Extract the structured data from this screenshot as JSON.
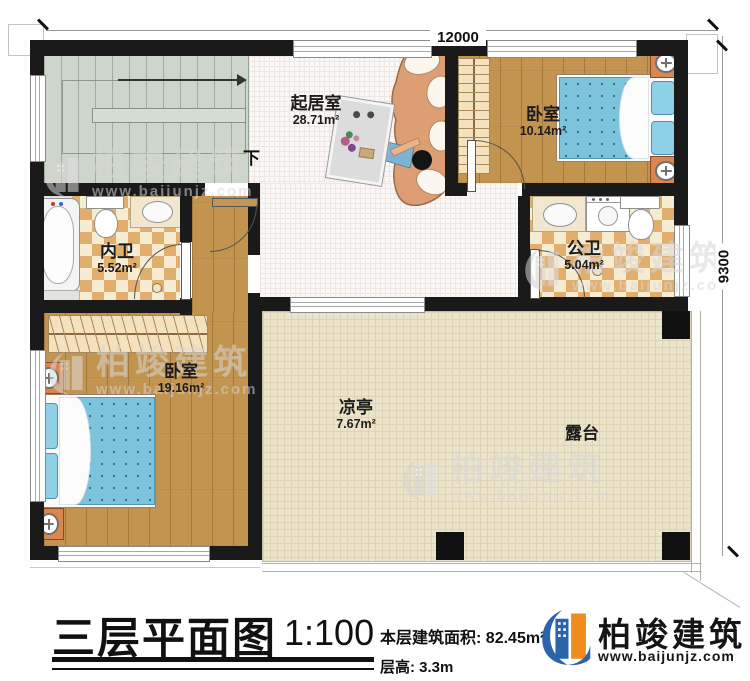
{
  "dimensions": {
    "top_width": "12000",
    "right_height": "9300"
  },
  "stairs": {
    "direction_label": "下"
  },
  "rooms": {
    "living": {
      "name": "起居室",
      "area": "28.71m²"
    },
    "bedroom_top": {
      "name": "卧室",
      "area": "10.14m²"
    },
    "bath_inner": {
      "name": "内卫",
      "area": "5.52m²"
    },
    "bath_public": {
      "name": "公卫",
      "area": "5.04m²"
    },
    "bedroom_left": {
      "name": "卧室",
      "area": "19.16m²"
    },
    "pavilion": {
      "name": "凉亭",
      "area": "7.67m²"
    },
    "terrace": {
      "name": "露台"
    }
  },
  "title_block": {
    "plan_title": "三层平面图",
    "scale": "1:100",
    "area_label": "本层建筑面积:",
    "area_value": "82.45m²",
    "floor_height_label": "层高:",
    "floor_height_value": "3.3m"
  },
  "brand": {
    "name": "柏竣建筑",
    "website": "www.baijunjz.com"
  },
  "watermark": {
    "name": "柏竣建筑",
    "website": "www.baijunjz.com"
  },
  "colors": {
    "wall": "#1a1a1a",
    "wood_floor": "#c2944f",
    "tile_dark": "#e2ae6e",
    "tile_light": "#f6ecd2",
    "terrace_floor": "#ece4ca",
    "stair_floor": "#ced5cb",
    "bed_blue": "#7cc3dc",
    "brand_blue": "#2b64ab",
    "brand_orange": "#f08c1e"
  }
}
